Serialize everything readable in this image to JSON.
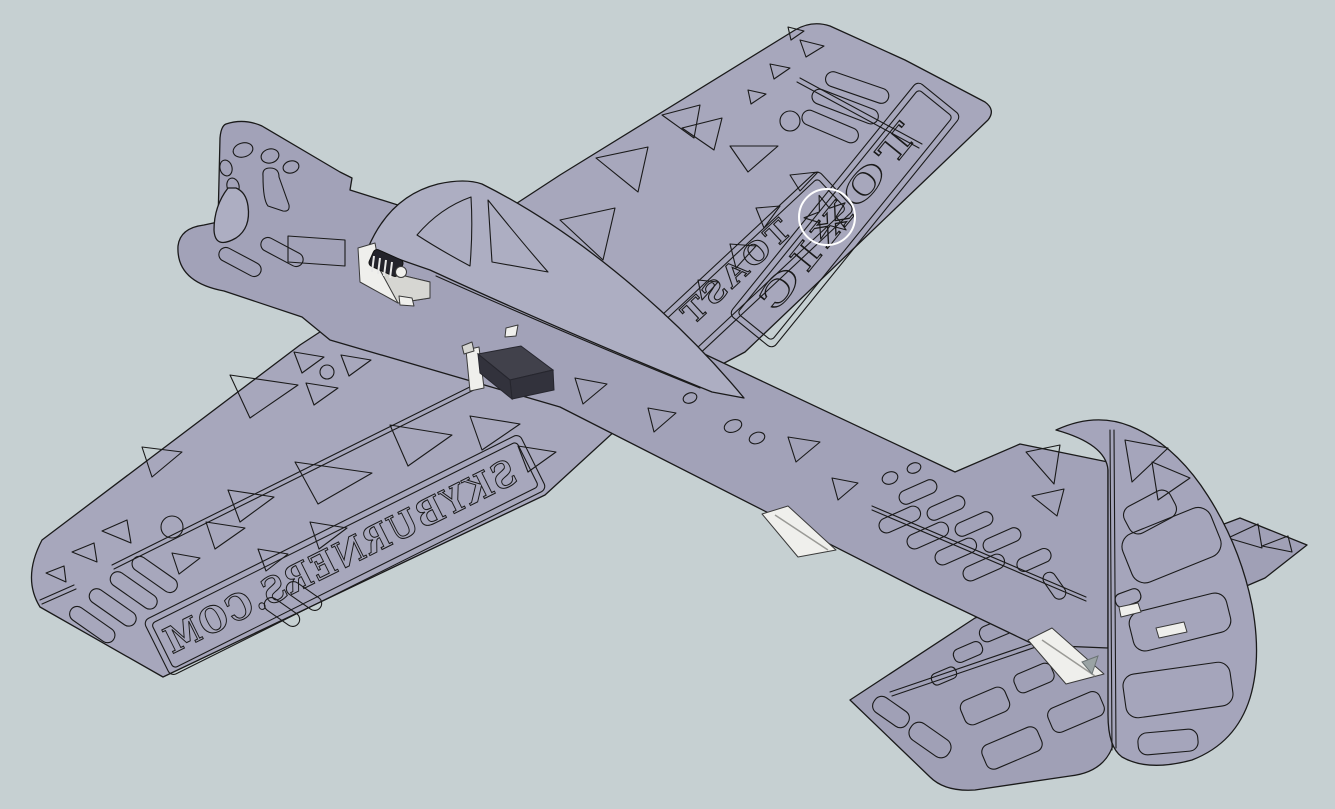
{
  "scene": {
    "background_color": "#c6d0d2",
    "material_color": "#a7a7bc",
    "edge_color": "#1a1a1a",
    "hardware_color": "#efefec",
    "electronics_color": "#41414b",
    "star_ring_color": "#ffffff"
  },
  "decals": {
    "left_wing_text": "SKYBURNERS.COM",
    "right_wing_text_outer": "TOXIC",
    "right_wing_text_inner": "TOAST",
    "star_icon": "5-point-star"
  }
}
